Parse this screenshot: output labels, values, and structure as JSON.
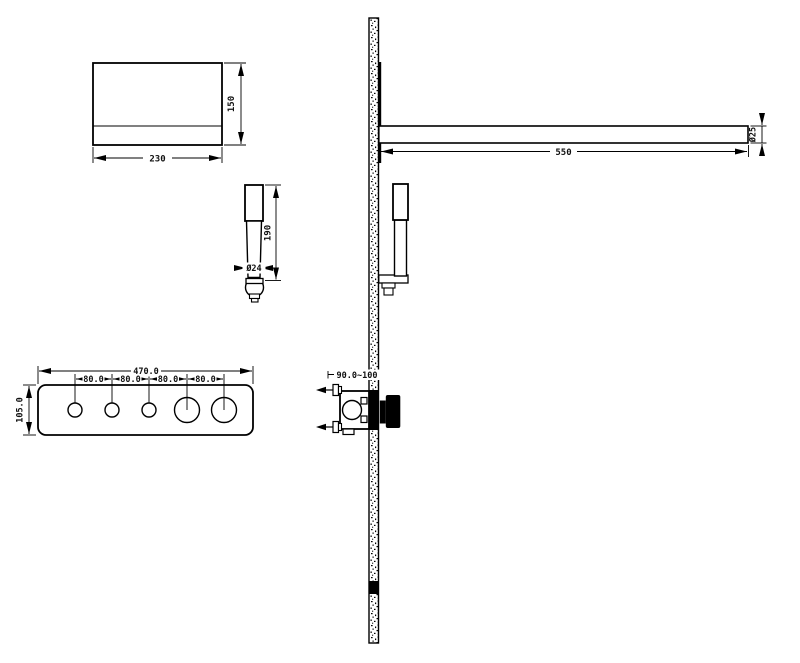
{
  "page": {
    "background": "#ffffff",
    "line_color": "#000000"
  },
  "drawing": {
    "overhead_shower": {
      "width": "230",
      "height": "150"
    },
    "hand_shower": {
      "length": "190",
      "diameter": "Ø24"
    },
    "control_panel": {
      "width": "470.0",
      "height": "105.0",
      "knob_spacing": [
        "80.0",
        "80.0",
        "80.0",
        "80.0"
      ]
    },
    "shower_arm": {
      "length": "550",
      "diameter": "Ø25"
    },
    "mixer_valve": {
      "mounting_depth": "90.0~100"
    }
  }
}
